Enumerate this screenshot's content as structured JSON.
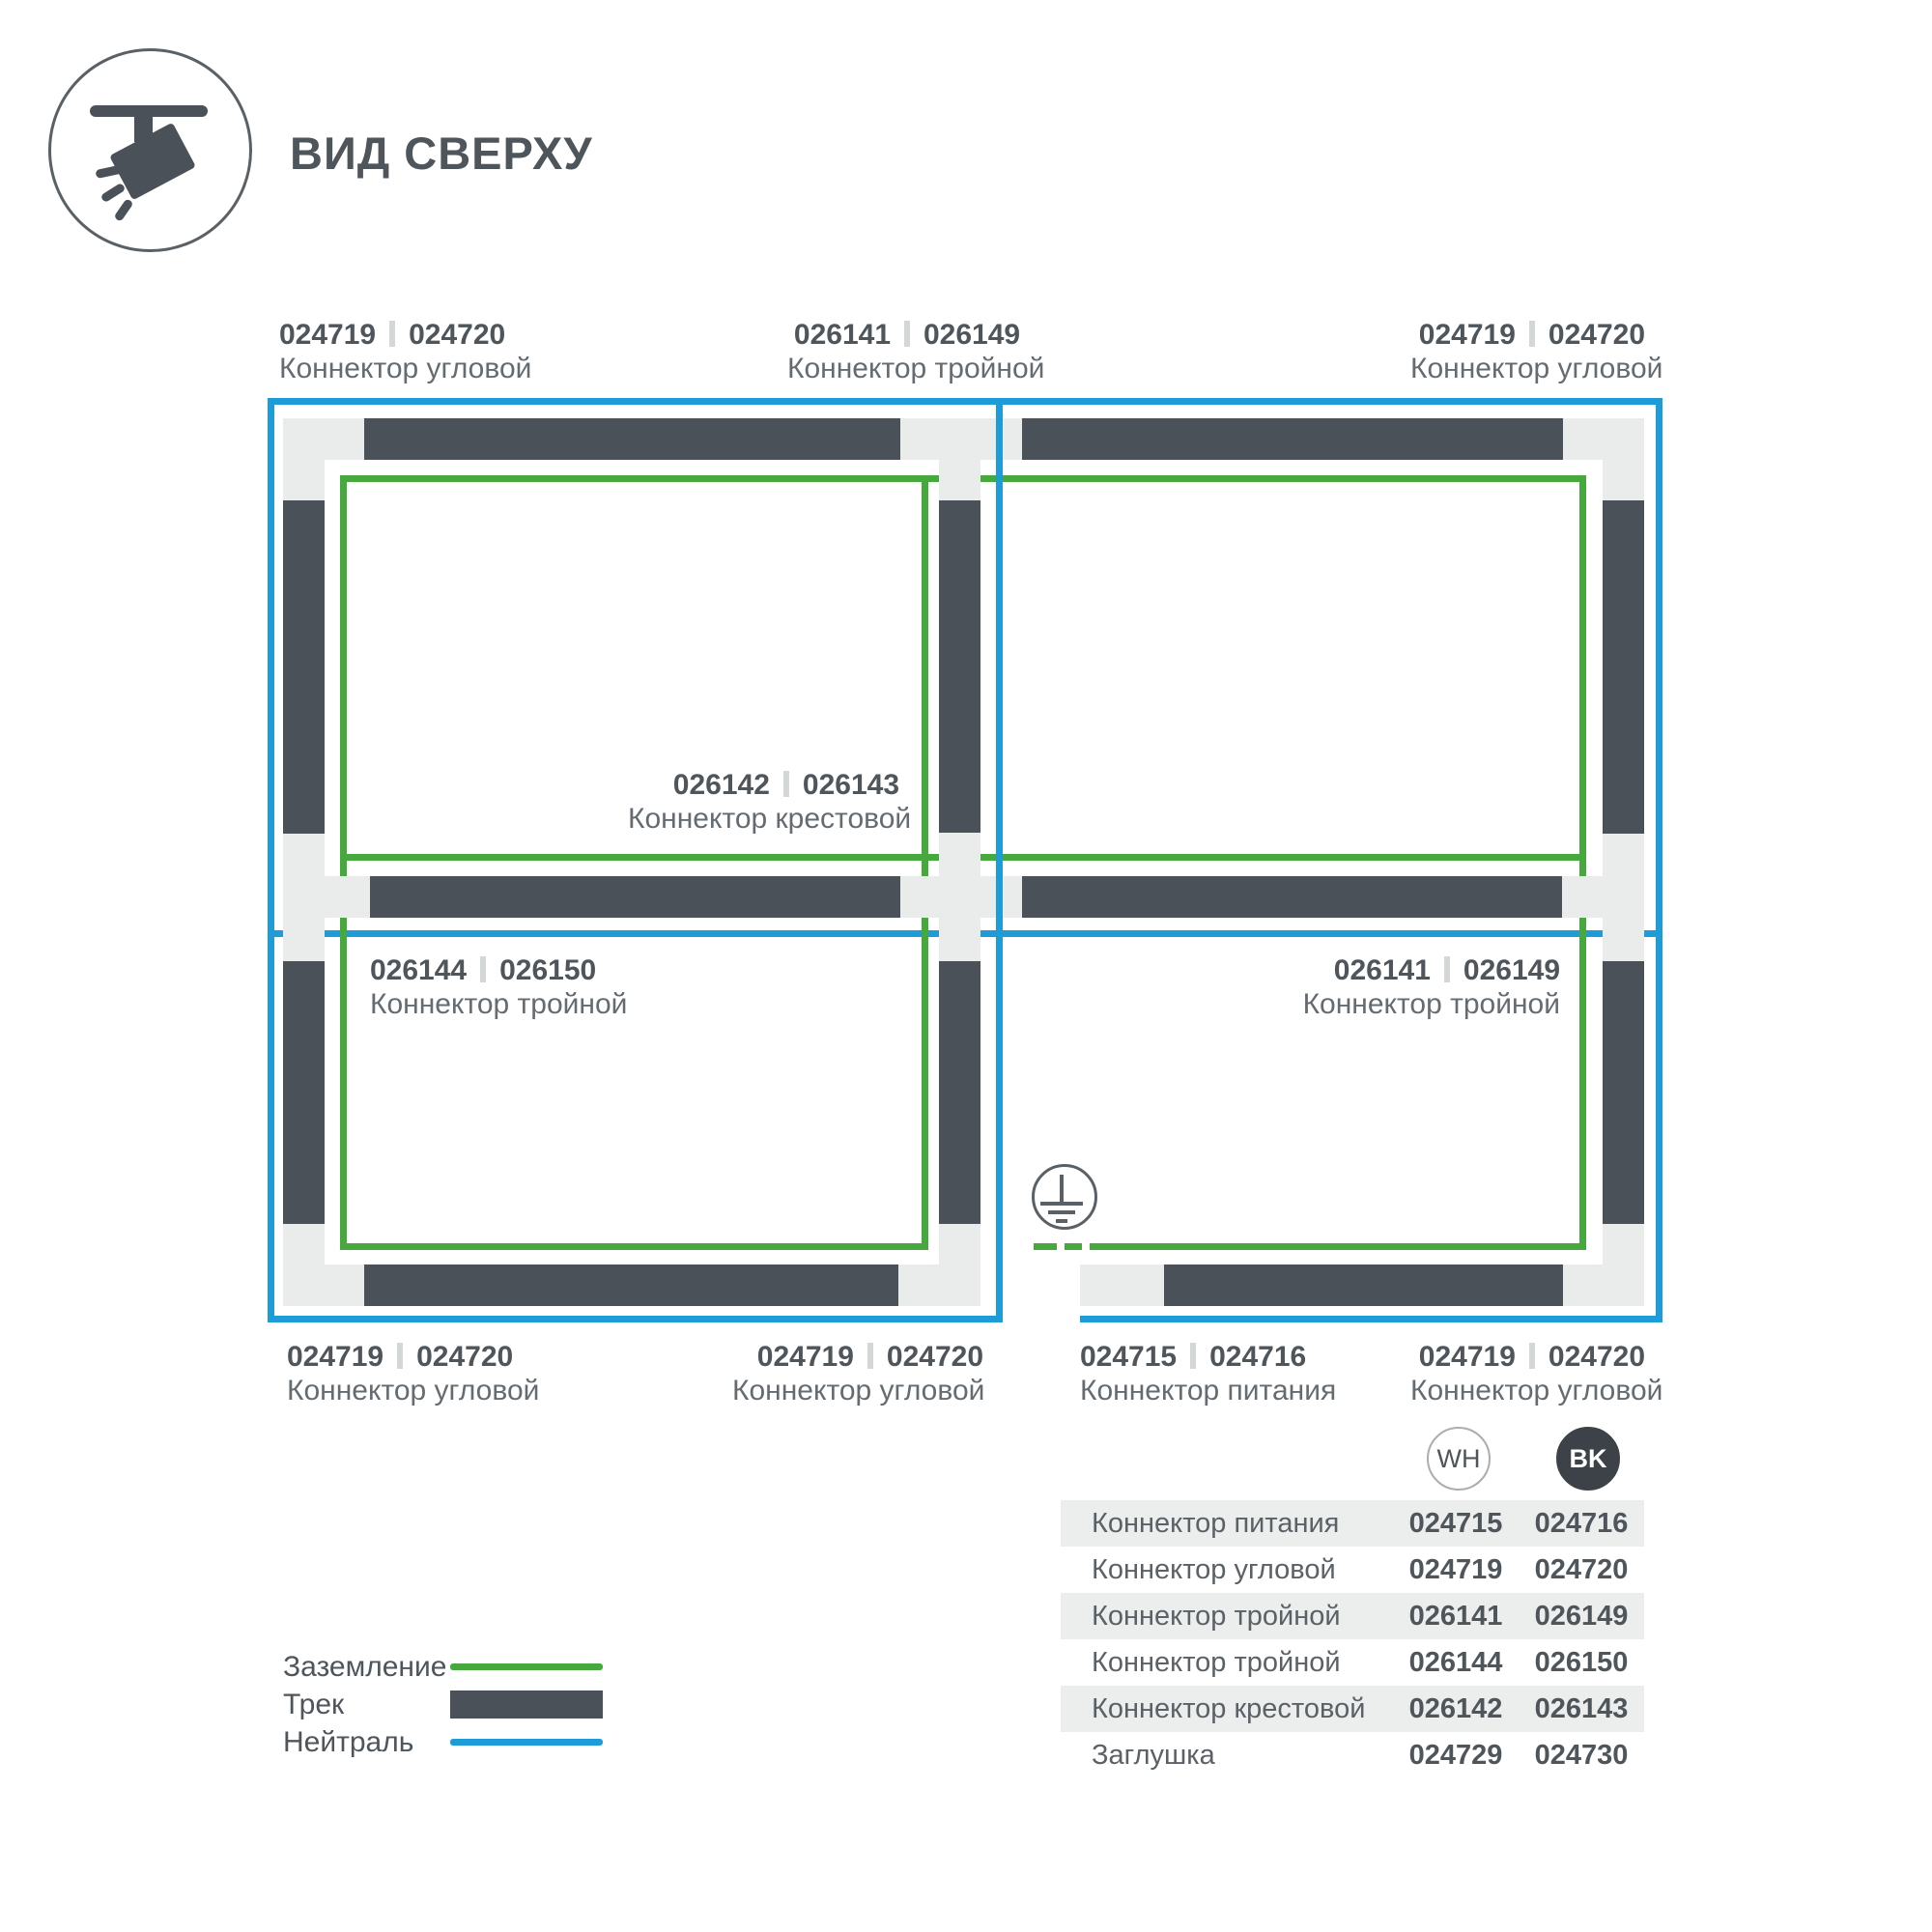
{
  "title": "ВИД СВЕРХУ",
  "colors": {
    "neutral_blue": "#1E9CD8",
    "ground_green": "#47A83E",
    "track_dark": "#4A5158",
    "connector_gray": "#EAECEC",
    "text_primary": "#4E555B",
    "text_secondary": "#646B71",
    "table_row_bg": "#ECEEEE",
    "bk_badge": "#3C4247"
  },
  "labels": {
    "top_left": {
      "code_wh": "024719",
      "code_bk": "024720",
      "name": "Коннектор угловой"
    },
    "top_middle": {
      "code_wh": "026141",
      "code_bk": "026149",
      "name": "Коннектор тройной"
    },
    "top_right": {
      "code_wh": "024719",
      "code_bk": "024720",
      "name": "Коннектор угловой"
    },
    "center": {
      "code_wh": "026142",
      "code_bk": "026143",
      "name": "Коннектор крестовой"
    },
    "mid_left": {
      "code_wh": "026144",
      "code_bk": "026150",
      "name": "Коннектор тройной"
    },
    "mid_right": {
      "code_wh": "026141",
      "code_bk": "026149",
      "name": "Коннектор тройной"
    },
    "bottom_left": {
      "code_wh": "024719",
      "code_bk": "024720",
      "name": "Коннектор угловой"
    },
    "bottom_middle": {
      "code_wh": "024719",
      "code_bk": "024720",
      "name": "Коннектор угловой"
    },
    "bottom_power": {
      "code_wh": "024715",
      "code_bk": "024716",
      "name": "Коннектор питания"
    },
    "bottom_right": {
      "code_wh": "024719",
      "code_bk": "024720",
      "name": "Коннектор угловой"
    }
  },
  "legend": {
    "ground": "Заземление",
    "track": "Трек",
    "neutral": "Нейтраль"
  },
  "table": {
    "col_wh": "WH",
    "col_bk": "BK",
    "rows": [
      {
        "name": "Коннектор питания",
        "wh": "024715",
        "bk": "024716"
      },
      {
        "name": "Коннектор угловой",
        "wh": "024719",
        "bk": "024720"
      },
      {
        "name": "Коннектор тройной",
        "wh": "026141",
        "bk": "026149"
      },
      {
        "name": "Коннектор тройной",
        "wh": "026144",
        "bk": "026150"
      },
      {
        "name": "Коннектор крестовой",
        "wh": "026142",
        "bk": "026143"
      },
      {
        "name": "Заглушка",
        "wh": "024729",
        "bk": "024730"
      }
    ]
  }
}
